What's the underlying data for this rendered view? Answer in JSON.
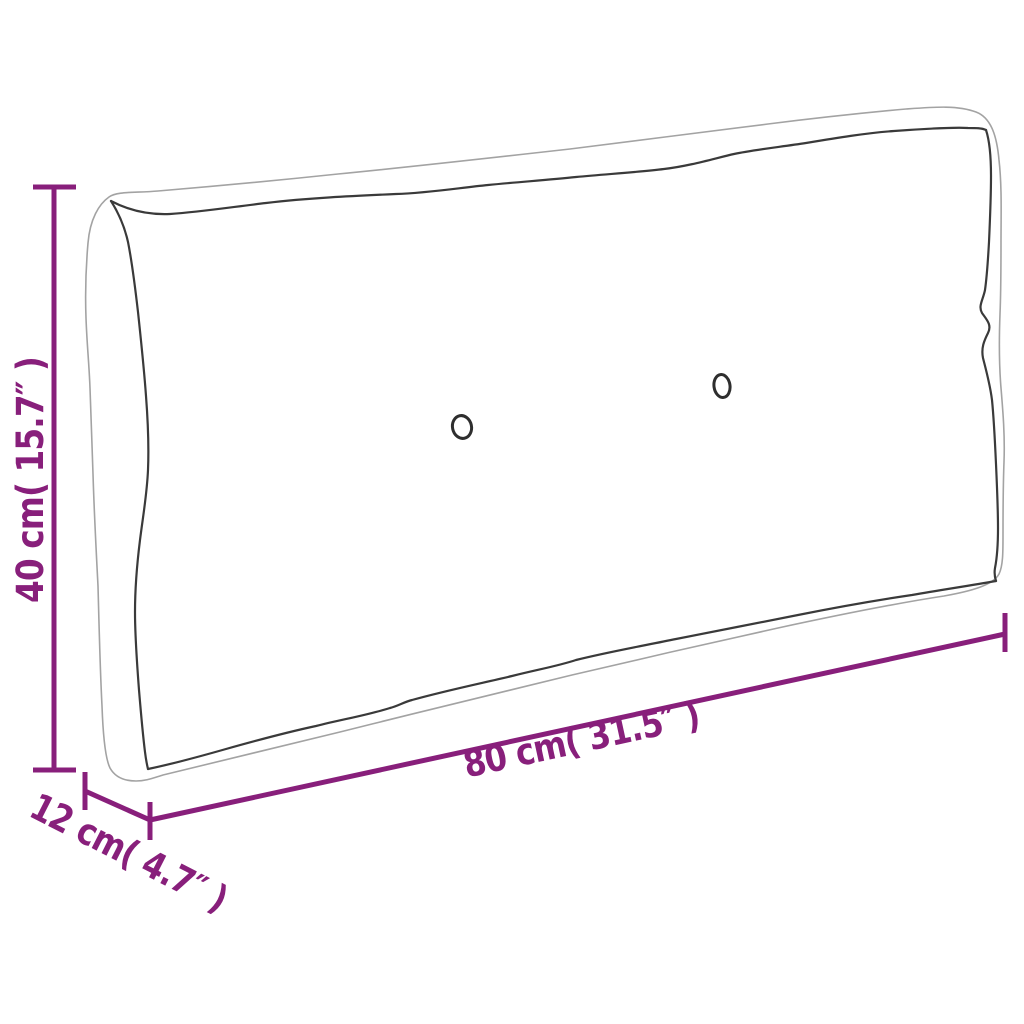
{
  "page": {
    "background": "#ffffff"
  },
  "diagram": {
    "kind": "product-dimension-drawing",
    "subject": "pallet-cushion-sketch",
    "accent_color": "#881F7B",
    "seam_color": "#3a3a3a",
    "silhouette_color": "#a3a3a3",
    "button_color": "#2e2e2e",
    "button_count": 2
  },
  "dimensions": {
    "height": {
      "label": "40 cm( 15.7″ )",
      "cm": "40",
      "inches": "15.7"
    },
    "depth": {
      "label": "12 cm( 4.7″ )",
      "cm": "12",
      "inches": "4.7"
    },
    "width": {
      "label": "80 cm( 31.5″ )",
      "cm": "80",
      "inches": "31.5"
    }
  }
}
